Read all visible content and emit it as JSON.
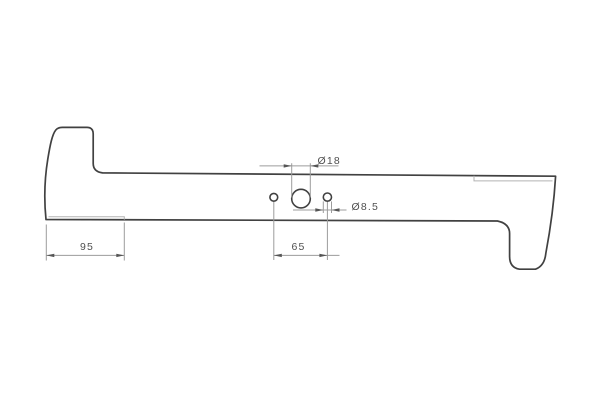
{
  "drawing": {
    "subject": "mower-blade-side-profile",
    "background_color": "#ffffff",
    "outline_color": "#414141",
    "bevel_line_color": "#b3b3b3",
    "dimension_line_color": "#9c9c9c",
    "label_color": "#4f4f4f",
    "dimensions": [
      {
        "id": "hub-hole-diameter",
        "label": "Ø18",
        "value": 18
      },
      {
        "id": "side-hole-diameter",
        "label": "Ø8.5",
        "value": 8.5
      },
      {
        "id": "left-end-length",
        "label": "95",
        "value": 95
      },
      {
        "id": "hole-spacing",
        "label": "65",
        "value": 65
      }
    ]
  }
}
